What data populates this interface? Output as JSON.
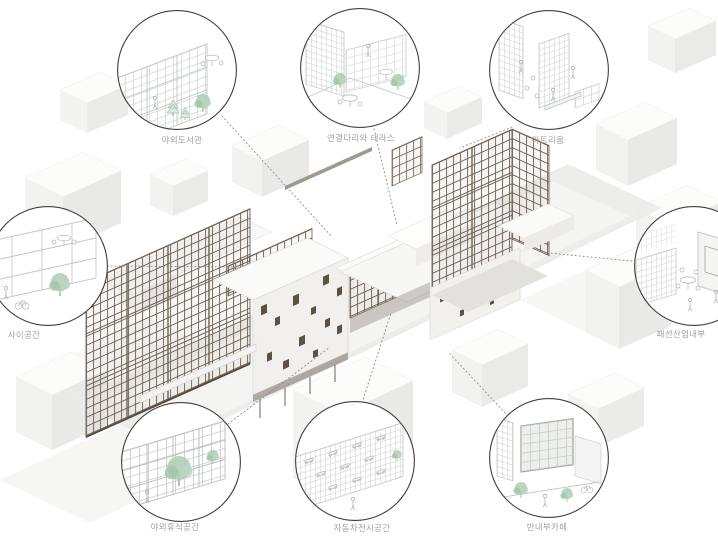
{
  "diagram": {
    "type": "architectural axonometric with circular detail callouts",
    "callouts": [
      {
        "id": "outdoor-library",
        "label": "야외도서관",
        "position": "top-left"
      },
      {
        "id": "bridge-and-terrace",
        "label": "연결다리와 테라스",
        "position": "top-center"
      },
      {
        "id": "atrium",
        "label": "아트리움",
        "position": "top-right"
      },
      {
        "id": "between-space",
        "label": "사이공간",
        "position": "middle-left"
      },
      {
        "id": "fashion-industry-interior",
        "label": "패션산업내부",
        "position": "middle-right"
      },
      {
        "id": "outdoor-rest-space",
        "label": "야외휴식공간",
        "position": "bottom-left"
      },
      {
        "id": "car-exhibition-space",
        "label": "자동차전시공간",
        "position": "bottom-center"
      },
      {
        "id": "semi-interior-cafe",
        "label": "반내부카페",
        "position": "bottom-right"
      }
    ],
    "colors": {
      "lattice_brown": "#6f6153",
      "wall_white": "#f1f0ed",
      "tree_green": "#aecdb6",
      "line_grey": "#c6cbc7",
      "label_grey": "#a2a2a2",
      "connector_grey": "#8b8b8b"
    }
  }
}
